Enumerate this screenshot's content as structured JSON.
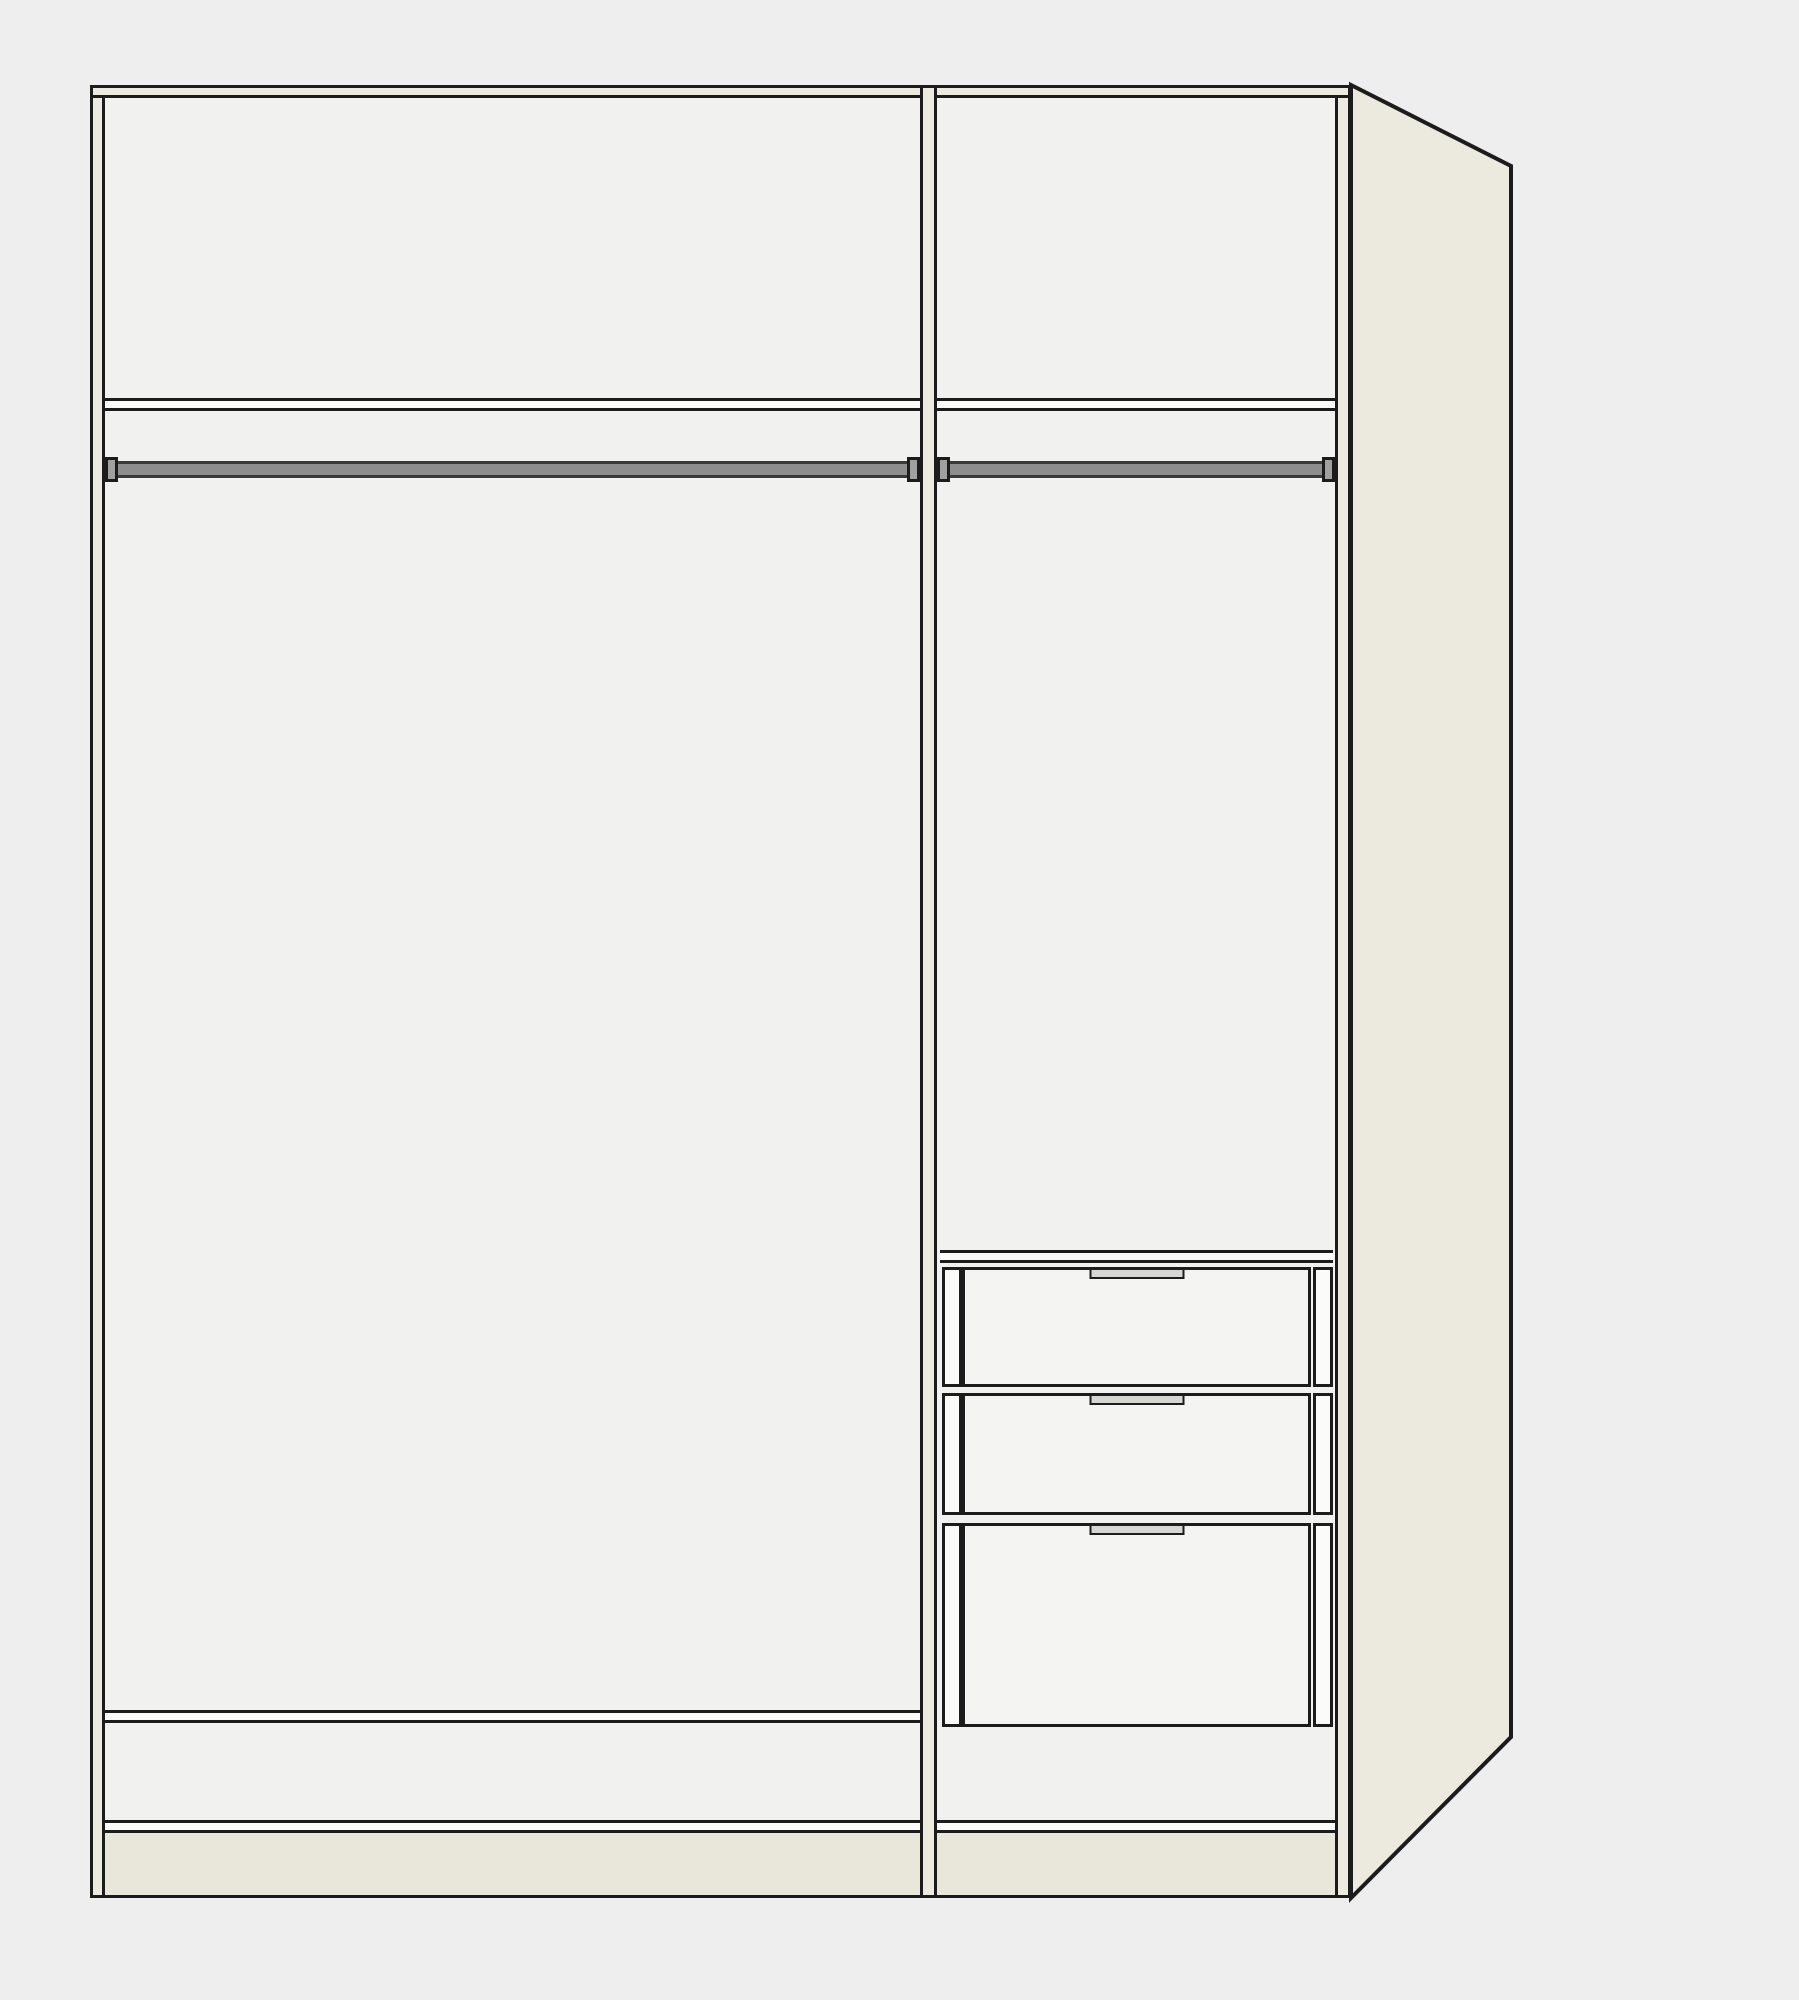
{
  "scene": {
    "kind": "empty wardrobe interior drawing, front view with right side panel in perspective",
    "sections": [
      {
        "name": "left section",
        "contents": [
          "top shelf",
          "clothes rail",
          "bottom shelf"
        ]
      },
      {
        "name": "right section",
        "contents": [
          "top shelf",
          "clothes rail",
          "drawer unit"
        ]
      }
    ],
    "drawer_unit": {
      "drawer_count": 3,
      "handle_style": "recessed grip bar centered at top edge of each drawer front"
    }
  },
  "colors": {
    "background": "#eeeeee",
    "interior": "#f1f1f0",
    "outline": "#1c1c1c",
    "frame_cream": "#edeadf",
    "side_panel": "#ece9df",
    "plinth": "#e9e6da",
    "shelf_white": "#fbfbfa",
    "drawer_front": "#f4f4f3",
    "clothes_rail_gray": "#8e8e8e",
    "handle_gray": "#d6d6d2"
  }
}
